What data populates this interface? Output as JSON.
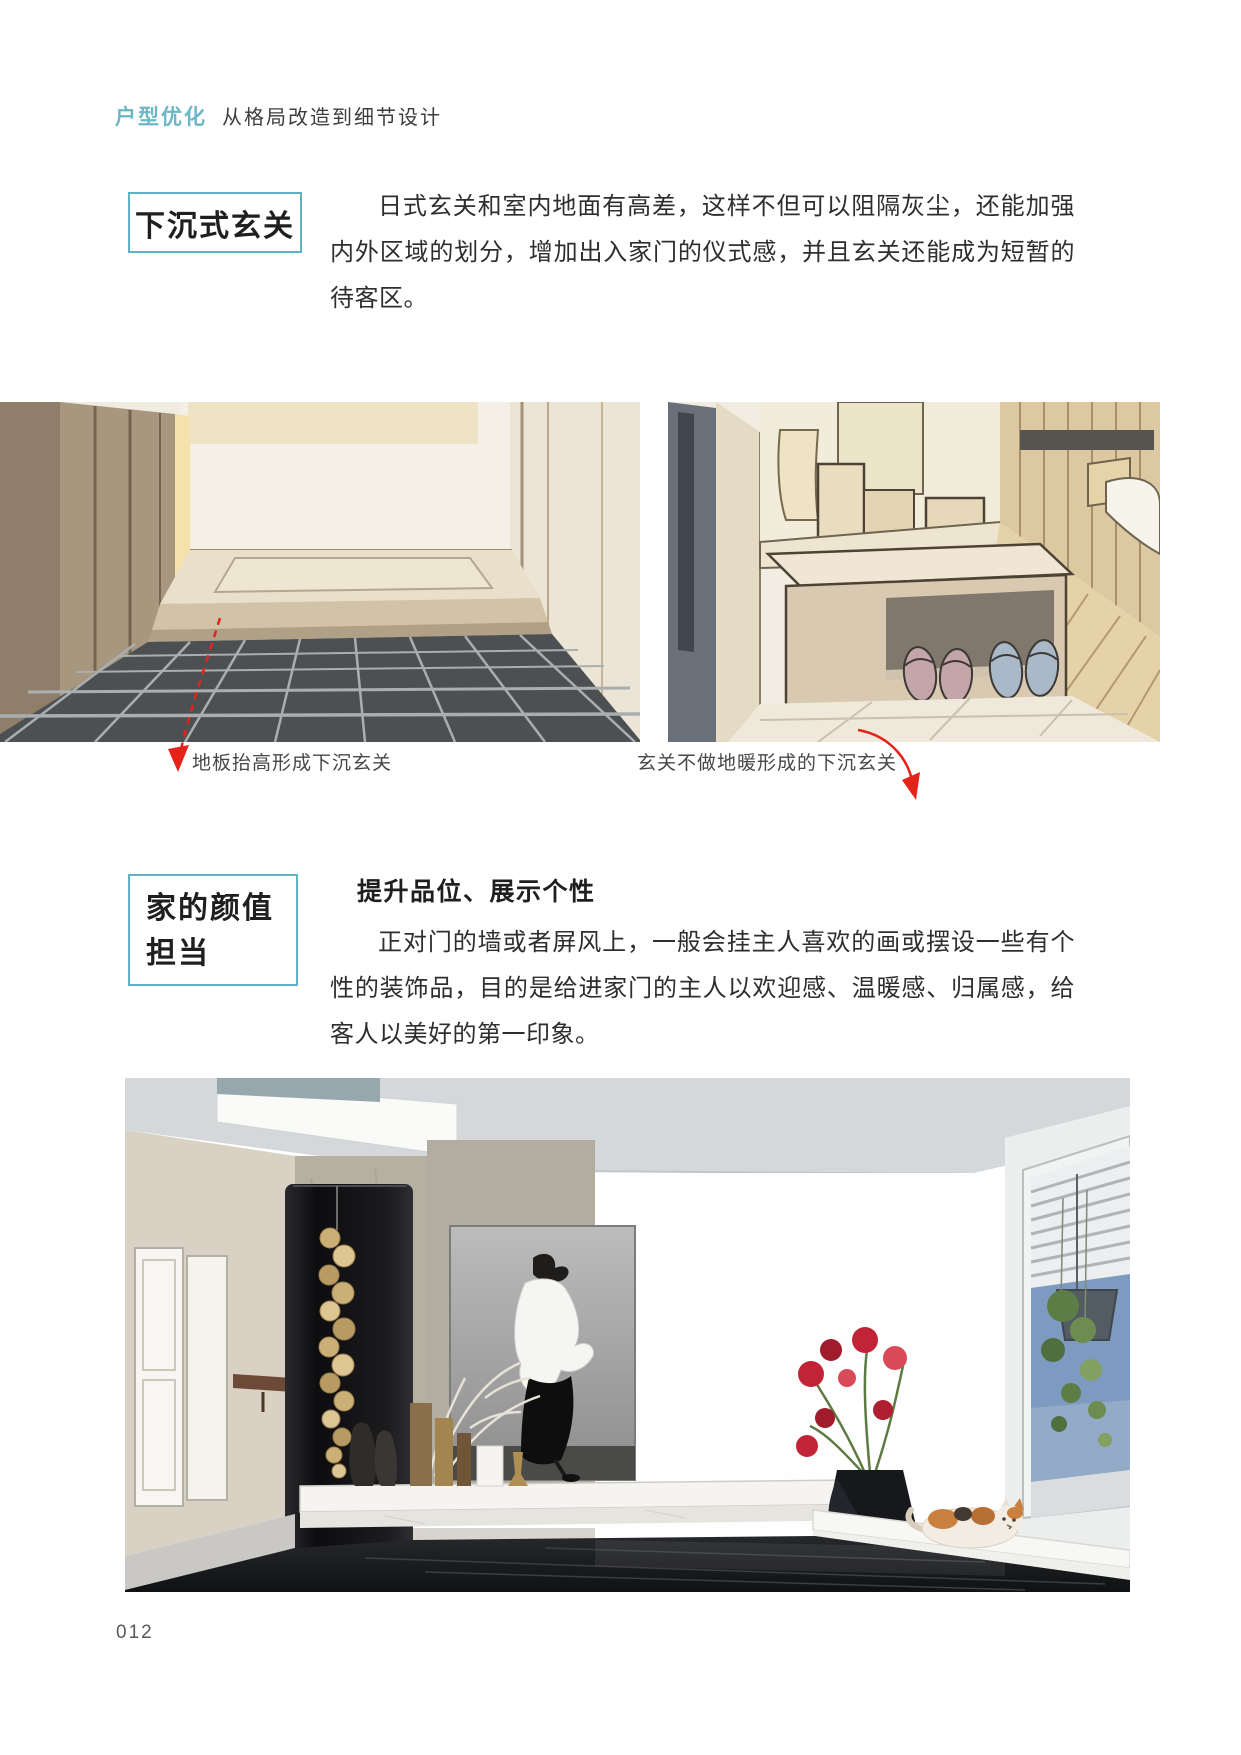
{
  "meta": {
    "accent_color": "#5fb2c6",
    "arrow_color": "#e5231b",
    "body_text_color": "#2e2e2e"
  },
  "header": {
    "highlight": "户型优化",
    "subtitle": "从格局改造到细节设计"
  },
  "page_number": "012",
  "sections": [
    {
      "title": "下沉式玄关",
      "paragraph": "日式玄关和室内地面有高差，这样不但可以阻隔灰尘，还能加强内外区域的划分，增加出入家门的仪式感，并且玄关还能成为短暂的待客区。",
      "figures": [
        {
          "caption": "地板抬高形成下沉玄关",
          "description": "手绘效果图：抬高的木地板台阶与下沉的深灰色瓷砖玄关，左侧为木质柜体"
        },
        {
          "caption": "玄关不做地暖形成的下沉玄关",
          "description": "手绘效果图：玄关换鞋凳下放拖鞋，右侧为抬高的木地板房间"
        }
      ]
    },
    {
      "title_line1": "家的颜值",
      "title_line2": "担当",
      "heading": "提升品位、展示个性",
      "paragraph": "正对门的墙或者屏风上，一般会挂主人喜欢的画或摆设一些有个性的装饰品，目的是给进家门的主人以欢迎感、温暖感、归属感，给客人以美好的第一印象。",
      "figure": {
        "description": "效果图：玄关黑色隔断挂金色装饰，人物挂画，大理石悬浮台摆件，右侧窗边长凳上有红色花束与花猫"
      }
    }
  ]
}
